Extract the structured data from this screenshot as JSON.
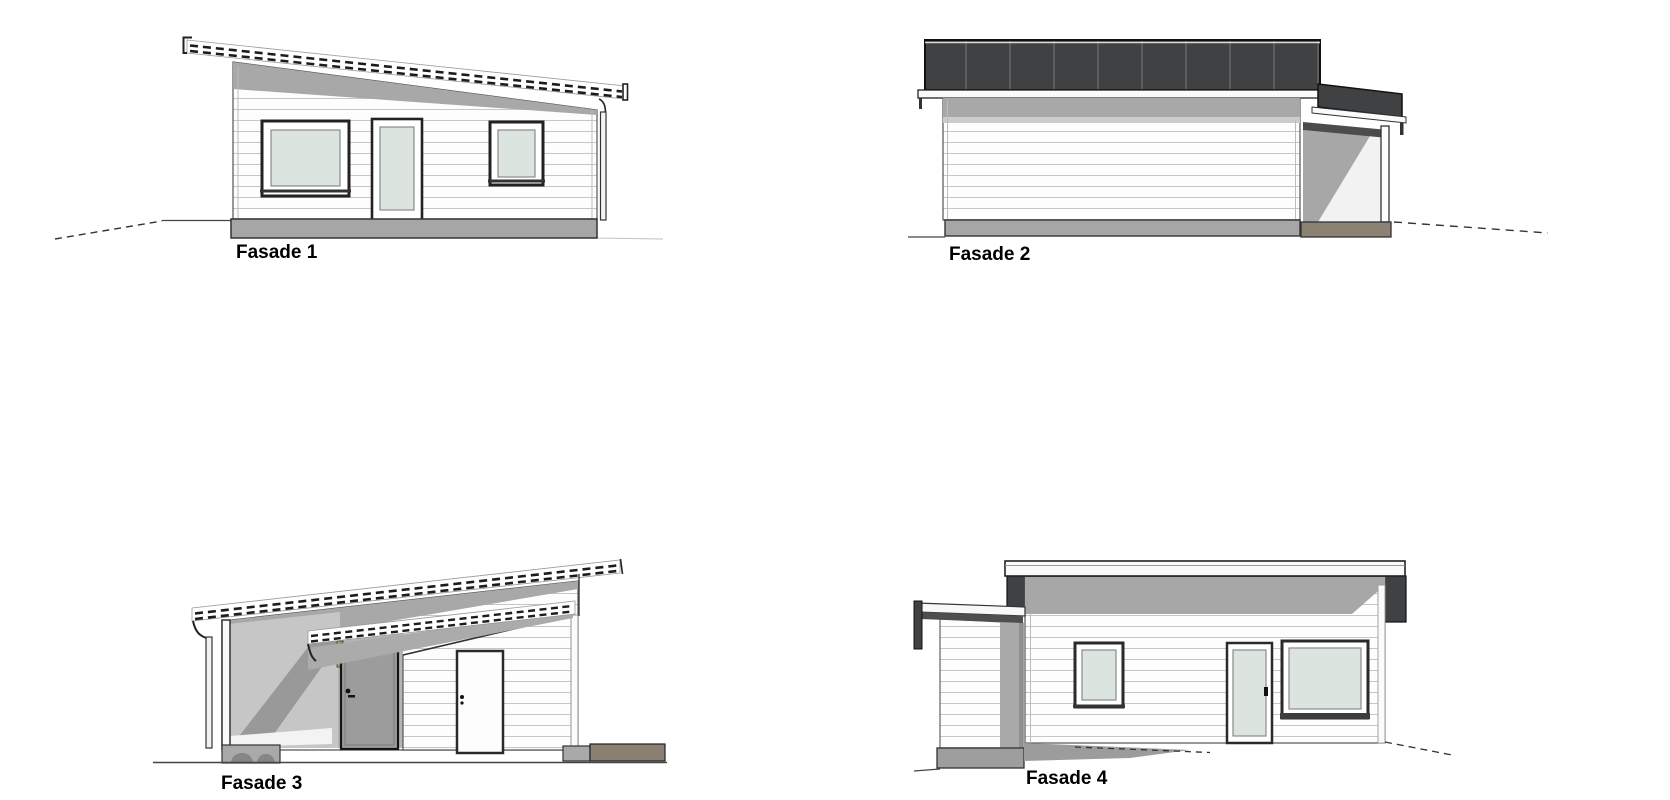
{
  "page": {
    "background": "#ffffff"
  },
  "drawing": {
    "type": "architectural-elevations",
    "elevations": [
      {
        "id": "fasade-1",
        "label": "Fasade 1"
      },
      {
        "id": "fasade-2",
        "label": "Fasade 2"
      },
      {
        "id": "fasade-3",
        "label": "Fasade 3"
      },
      {
        "id": "fasade-4",
        "label": "Fasade 4"
      }
    ],
    "colors": {
      "roof_dark": "#3f4143",
      "roof_seam": "#5b5d5f",
      "eaves_shadow": "#a8a8a8",
      "plinth_gray": "#a6a6a6",
      "plinth_taupe": "#8b8274",
      "glass": "#dbe4df",
      "siding_line": "#c6c6c6",
      "outline": "#1a1a1a"
    }
  }
}
